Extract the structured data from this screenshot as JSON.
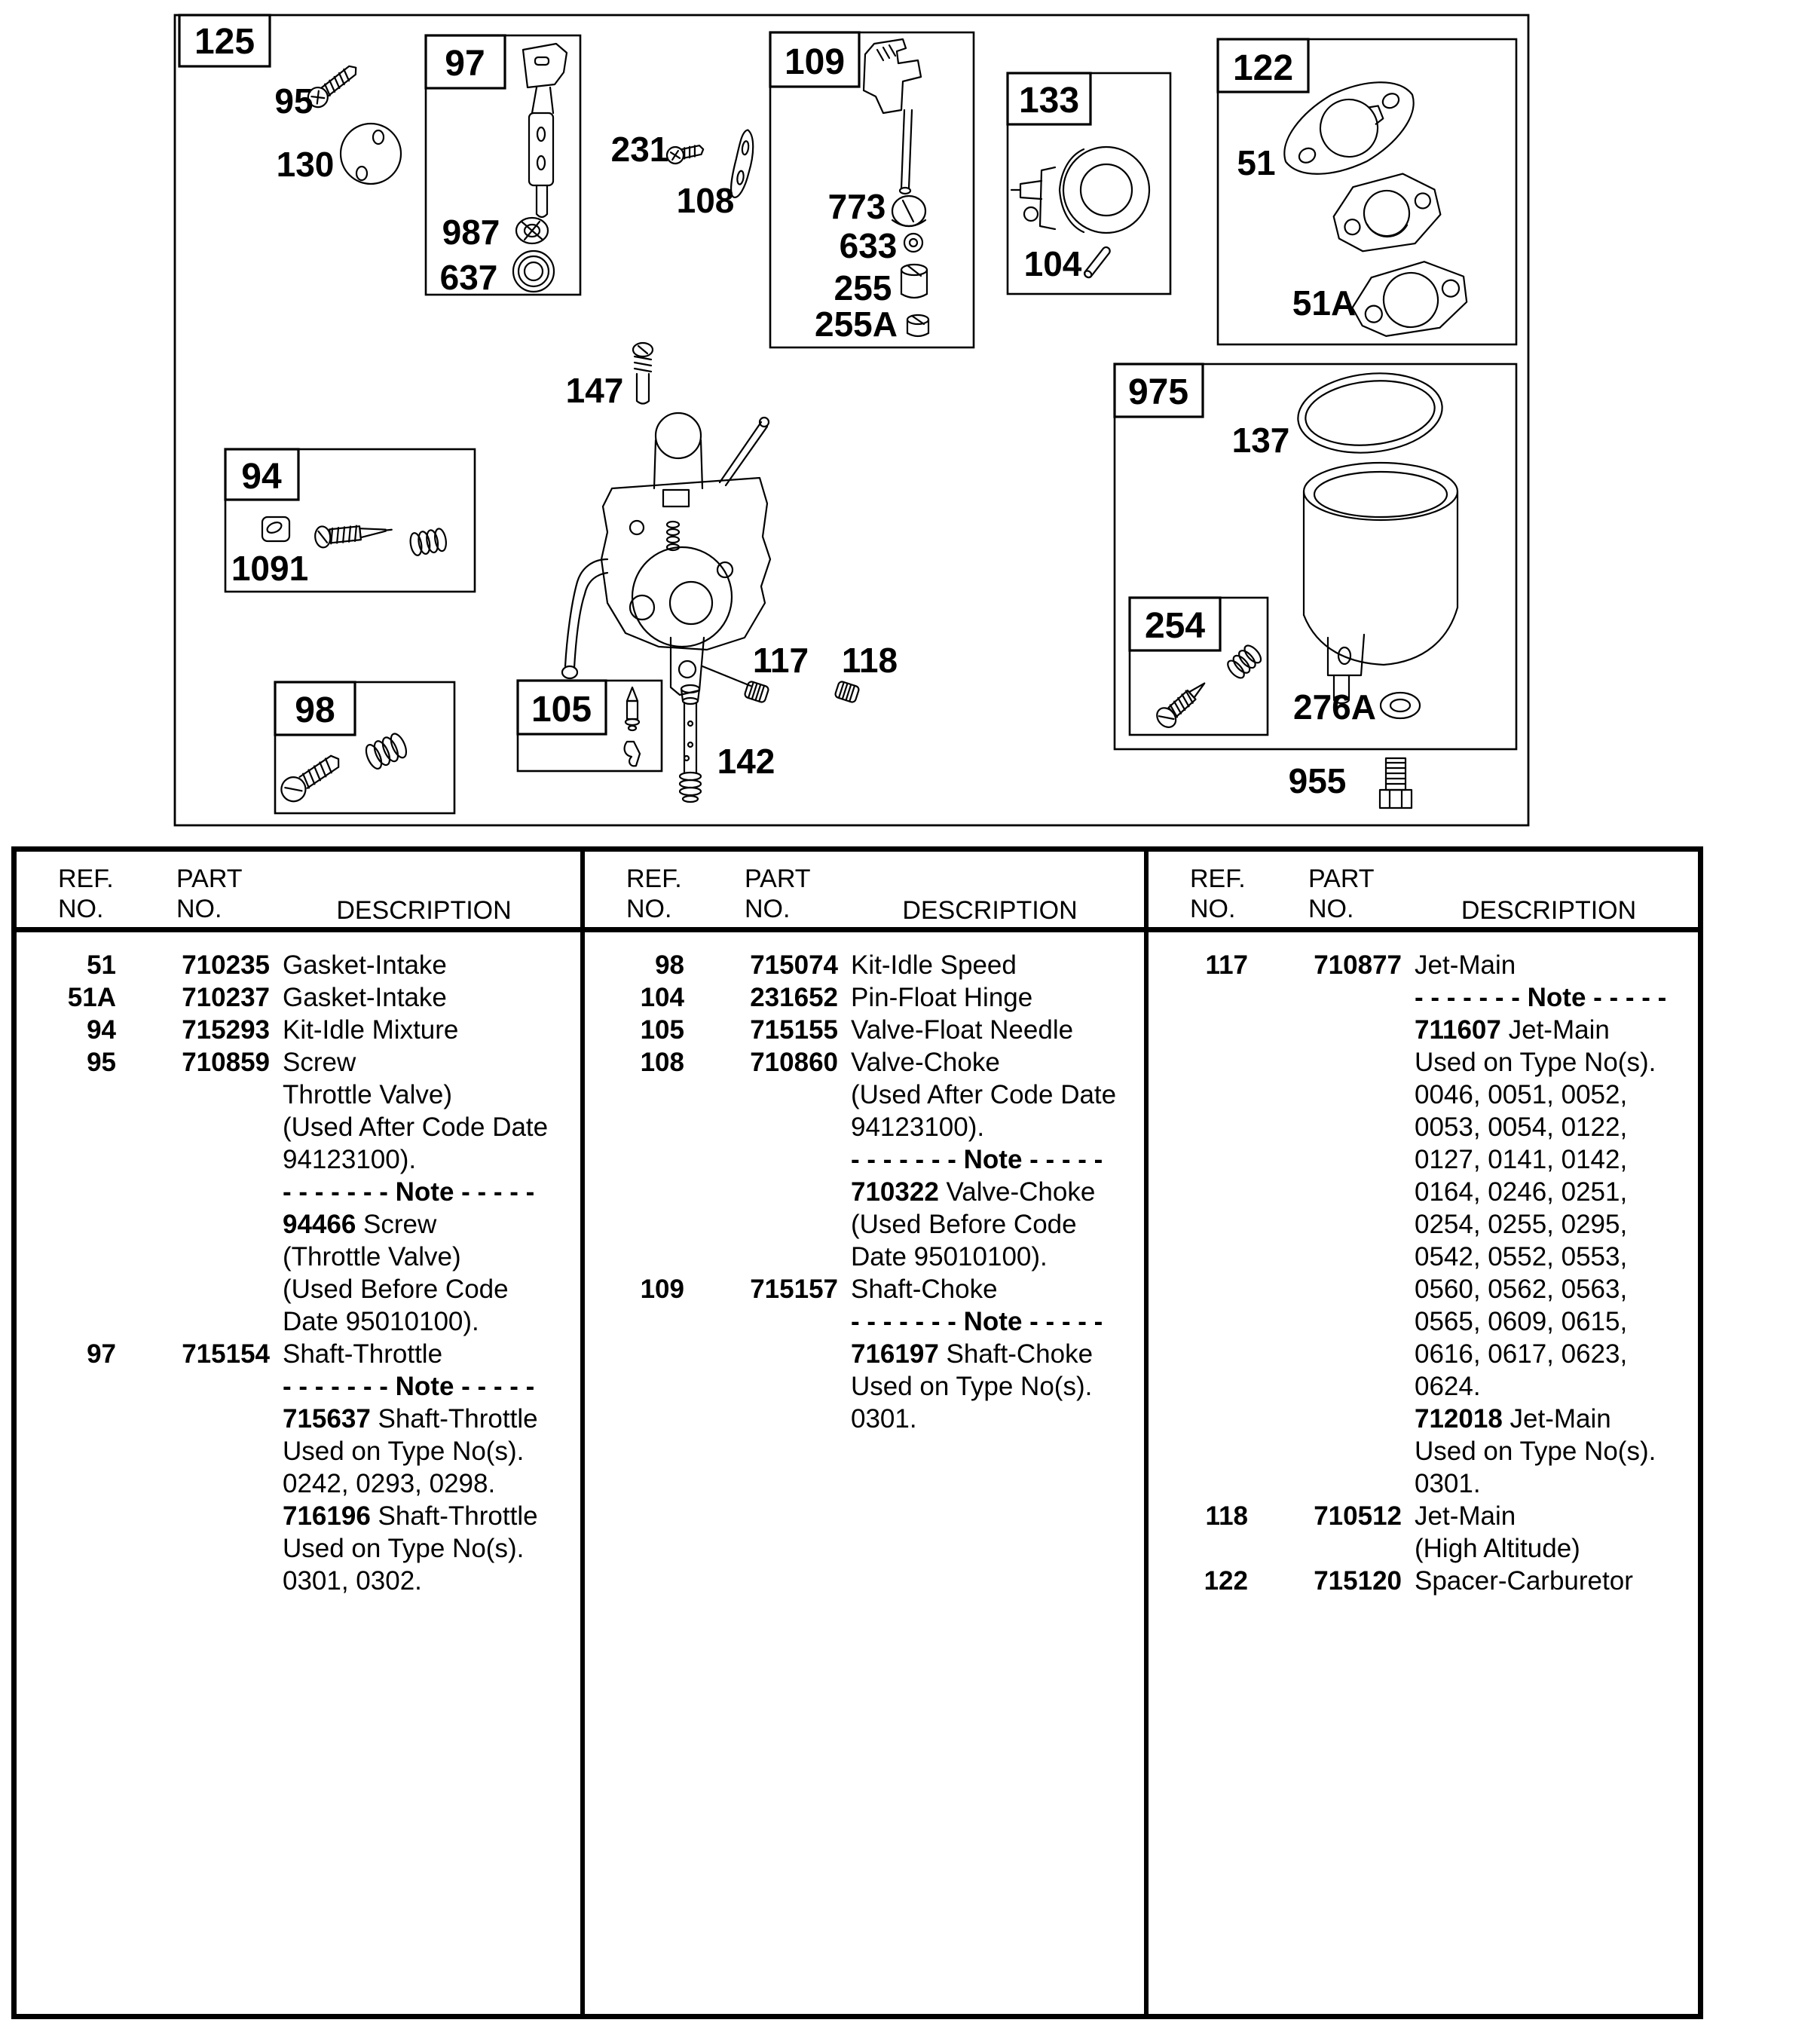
{
  "diagram": {
    "labels": {
      "125": "125",
      "95": "95",
      "130": "130",
      "97": "97",
      "987": "987",
      "637": "637",
      "231": "231",
      "108": "108",
      "109": "109",
      "773": "773",
      "633": "633",
      "255": "255",
      "255A": "255A",
      "133": "133",
      "104": "104",
      "122": "122",
      "51": "51",
      "51A": "51A",
      "147": "147",
      "94": "94",
      "1091": "1091",
      "117": "117",
      "118": "118",
      "98": "98",
      "105": "105",
      "142": "142",
      "975": "975",
      "137": "137",
      "254": "254",
      "276A": "276A",
      "955": "955"
    }
  },
  "table": {
    "headers": {
      "ref1": "REF.",
      "ref2": "NO.",
      "part1": "PART",
      "part2": "NO.",
      "desc": "DESCRIPTION"
    },
    "groups": [
      {
        "rows": [
          {
            "ref": "51",
            "part": "710235",
            "desc": [
              {
                "t": "Gasket-Intake"
              }
            ]
          },
          {
            "ref": "51A",
            "part": "710237",
            "desc": [
              {
                "t": "Gasket-Intake"
              }
            ]
          },
          {
            "ref": "94",
            "part": "715293",
            "desc": [
              {
                "t": "Kit-Idle Mixture"
              }
            ]
          },
          {
            "ref": "95",
            "part": "710859",
            "desc": [
              {
                "t": "Screw"
              },
              {
                "t": "Throttle Valve)"
              },
              {
                "t": "(Used After Code Date"
              },
              {
                "t": "94123100)."
              },
              {
                "b": "- - - - - - - Note - - - - -"
              },
              {
                "b": "94466",
                "t": " Screw"
              },
              {
                "t": "(Throttle Valve)"
              },
              {
                "t": "(Used Before Code"
              },
              {
                "t": "Date 95010100)."
              }
            ]
          },
          {
            "ref": "97",
            "part": "715154",
            "desc": [
              {
                "t": "Shaft-Throttle"
              },
              {
                "b": "- - - - - - - Note - - - - -"
              },
              {
                "b": "715637",
                "t": " Shaft-Throttle"
              },
              {
                "t": "Used on Type No(s)."
              },
              {
                "t": "0242, 0293, 0298."
              },
              {
                "b": "716196",
                "t": " Shaft-Throttle"
              },
              {
                "t": "Used on Type No(s)."
              },
              {
                "t": "0301, 0302."
              }
            ]
          }
        ]
      },
      {
        "rows": [
          {
            "ref": "98",
            "part": "715074",
            "desc": [
              {
                "t": "Kit-Idle Speed"
              }
            ]
          },
          {
            "ref": "104",
            "part": "231652",
            "desc": [
              {
                "t": "Pin-Float Hinge"
              }
            ]
          },
          {
            "ref": "105",
            "part": "715155",
            "desc": [
              {
                "t": "Valve-Float Needle"
              }
            ]
          },
          {
            "ref": "108",
            "part": "710860",
            "desc": [
              {
                "t": "Valve-Choke"
              },
              {
                "t": "(Used After Code Date"
              },
              {
                "t": "94123100)."
              },
              {
                "b": "- - - - - - - Note - - - - -"
              },
              {
                "b": "710322",
                "t": " Valve-Choke"
              },
              {
                "t": "(Used Before Code"
              },
              {
                "t": "Date 95010100)."
              }
            ]
          },
          {
            "ref": "109",
            "part": "715157",
            "desc": [
              {
                "t": "Shaft-Choke"
              },
              {
                "b": "- - - - - - - Note - - - - -"
              },
              {
                "b": "716197",
                "t": " Shaft-Choke"
              },
              {
                "t": "Used on Type No(s)."
              },
              {
                "t": "0301."
              }
            ]
          }
        ]
      },
      {
        "rows": [
          {
            "ref": "117",
            "part": "710877",
            "desc": [
              {
                "t": "Jet-Main"
              },
              {
                "b": "- - - - - - - Note - - - - -"
              },
              {
                "b": "711607",
                "t": " Jet-Main"
              },
              {
                "t": "Used on Type No(s)."
              },
              {
                "t": "0046, 0051, 0052,"
              },
              {
                "t": "0053, 0054, 0122,"
              },
              {
                "t": "0127, 0141, 0142,"
              },
              {
                "t": "0164, 0246, 0251,"
              },
              {
                "t": "0254, 0255, 0295,"
              },
              {
                "t": "0542, 0552, 0553,"
              },
              {
                "t": "0560, 0562, 0563,"
              },
              {
                "t": "0565, 0609, 0615,"
              },
              {
                "t": "0616, 0617, 0623,"
              },
              {
                "t": "0624."
              },
              {
                "b": "712018",
                "t": " Jet-Main"
              },
              {
                "t": "Used on Type No(s)."
              },
              {
                "t": "0301."
              }
            ]
          },
          {
            "ref": "118",
            "part": "710512",
            "desc": [
              {
                "t": "Jet-Main"
              },
              {
                "t": "(High Altitude)"
              }
            ]
          },
          {
            "ref": "122",
            "part": "715120",
            "desc": [
              {
                "t": "Spacer-Carburetor"
              }
            ]
          }
        ]
      }
    ]
  }
}
